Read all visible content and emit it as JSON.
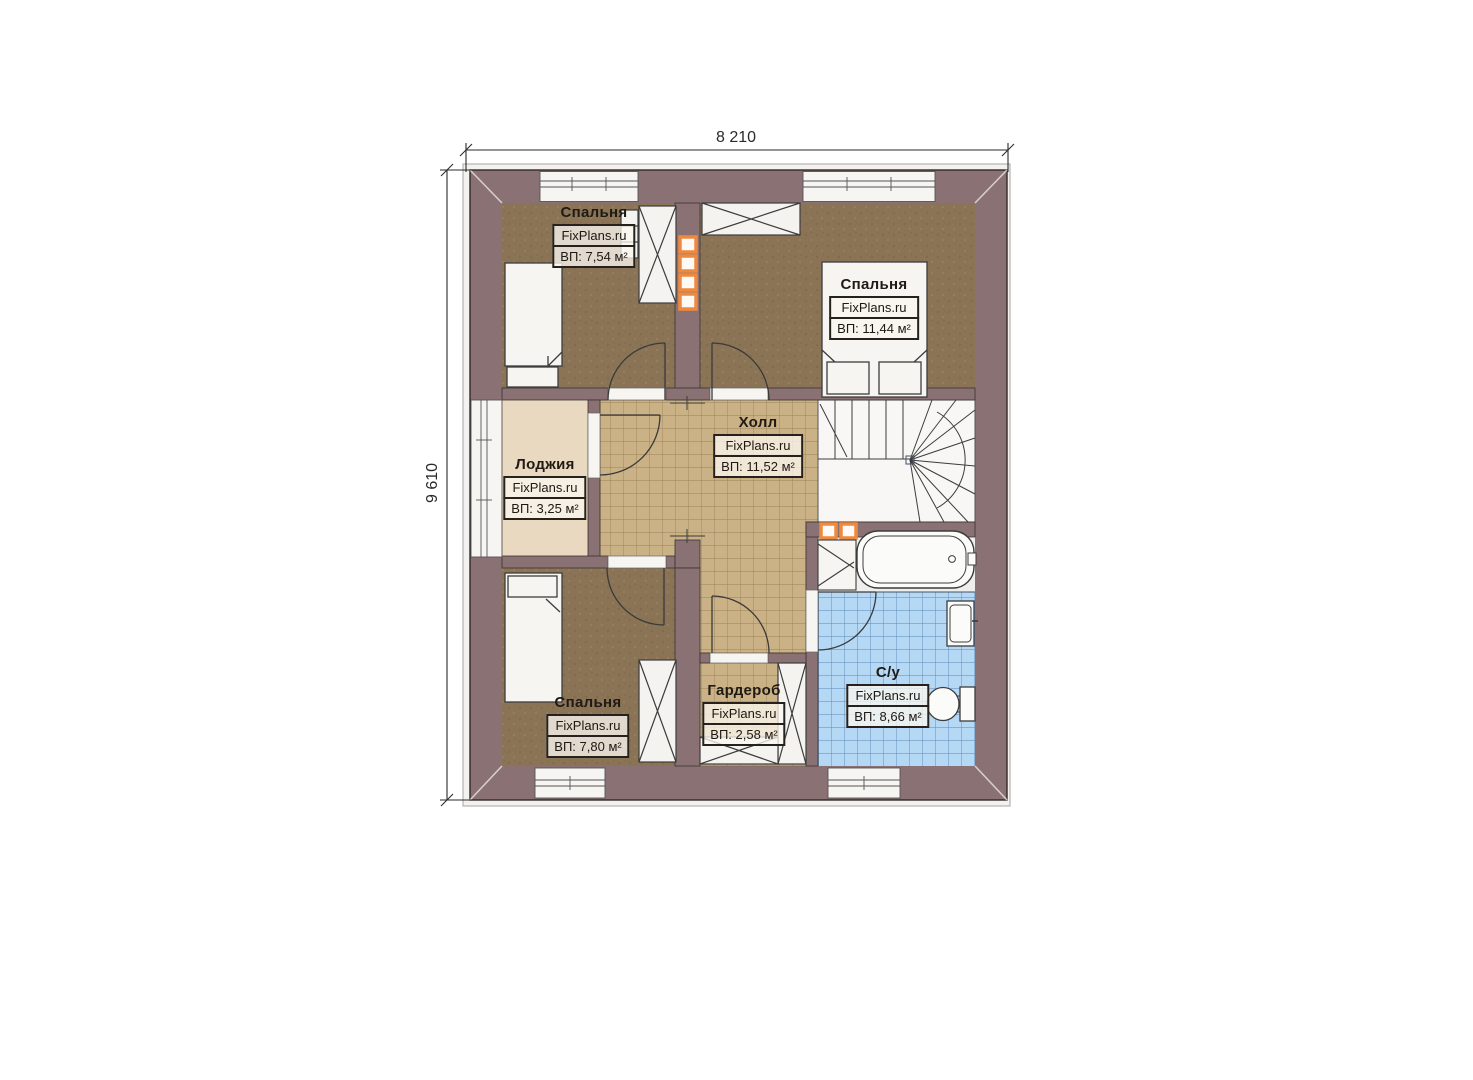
{
  "plan": {
    "title": "Attic floor plan",
    "brand": "FixPlans.ru",
    "dimensions": {
      "width": "8 210",
      "height": "9 610"
    },
    "rooms": [
      {
        "id": "bedroom-top-left",
        "name": "Спальня",
        "brand": "FixPlans.ru",
        "area": "ВП: 7,54 м²"
      },
      {
        "id": "bedroom-top-right",
        "name": "Спальня",
        "brand": "FixPlans.ru",
        "area": "ВП: 11,44 м²"
      },
      {
        "id": "loggia",
        "name": "Лоджия",
        "brand": "FixPlans.ru",
        "area": "ВП: 3,25 м²"
      },
      {
        "id": "hall",
        "name": "Холл",
        "brand": "FixPlans.ru",
        "area": "ВП: 11,52 м²"
      },
      {
        "id": "bedroom-bottom-left",
        "name": "Спальня",
        "brand": "FixPlans.ru",
        "area": "ВП: 7,80 м²"
      },
      {
        "id": "wardrobe",
        "name": "Гардероб",
        "brand": "FixPlans.ru",
        "area": "ВП: 2,58 м²"
      },
      {
        "id": "bathroom",
        "name": "С/у",
        "brand": "FixPlans.ru",
        "area": "ВП: 8,66 м²"
      }
    ],
    "colors": {
      "wall": "#8a7173",
      "bedroom_floor": "#8b7456",
      "hall_tile": "#cbb286",
      "hall_tile_line": "#9b8257",
      "loggia_floor": "#e9d9c0",
      "bath_tile": "#b5d9f5",
      "bath_tile_line": "#5c86b8",
      "vent_accent": "#ee8a3f",
      "fixture_white": "#f6f5f2"
    }
  }
}
